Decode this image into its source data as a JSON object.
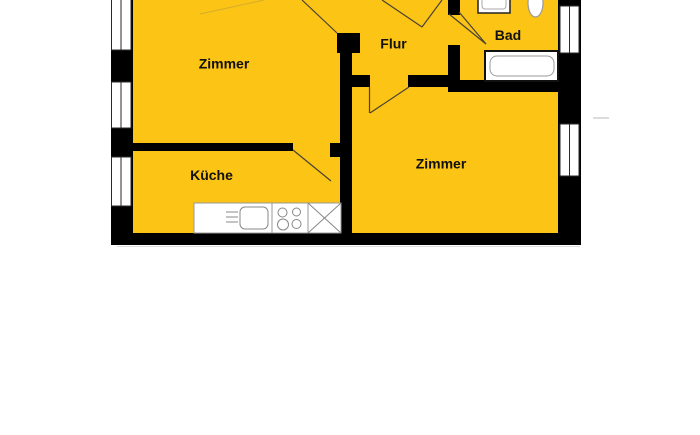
{
  "floor_plan": {
    "kind": "apartment-floor-plan",
    "colors": {
      "room_fill": "#FCC414",
      "wall": "#000000",
      "door_line": "#4a4236",
      "fixture_stroke": "#8e8e8e",
      "window_fill": "#ffffff"
    },
    "rooms": [
      {
        "id": "zimmer-left",
        "label": "Zimmer"
      },
      {
        "id": "flur",
        "label": "Flur"
      },
      {
        "id": "bad",
        "label": "Bad"
      },
      {
        "id": "kueche",
        "label": "Küche"
      },
      {
        "id": "zimmer-right",
        "label": "Zimmer"
      }
    ],
    "fixtures": [
      "bathtub",
      "washbasin",
      "toilet",
      "kitchen-counter",
      "kitchen-sink",
      "stove-hotplates",
      "fridge-cross-box"
    ],
    "window_count": 5
  }
}
